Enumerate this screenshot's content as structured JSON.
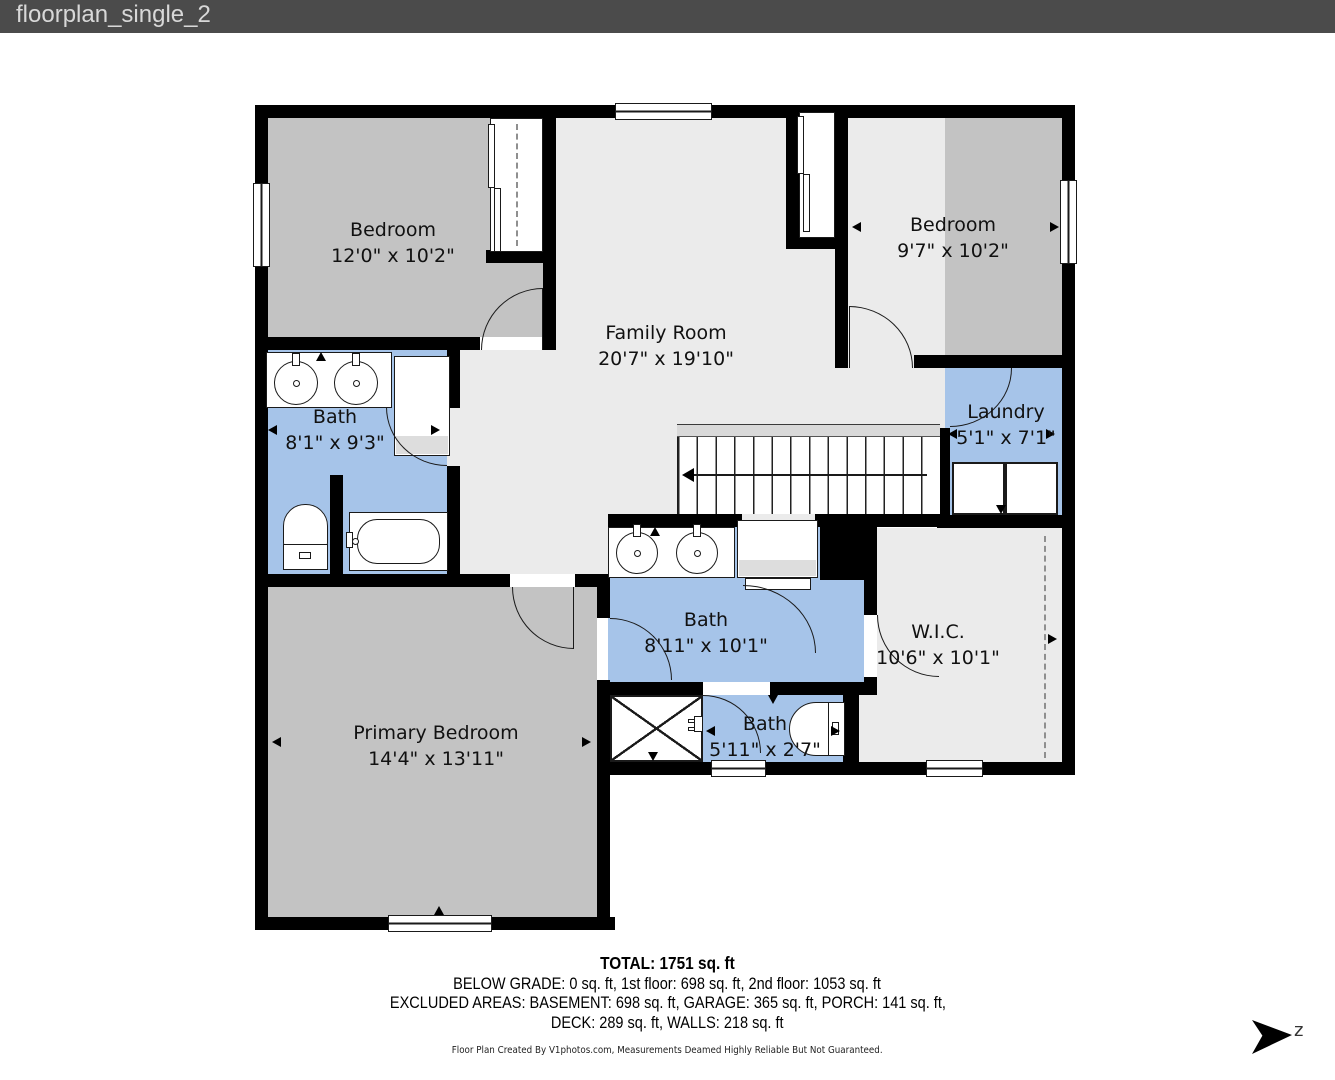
{
  "title_bar": {
    "title": "floorplan_single_2"
  },
  "rooms": [
    {
      "id": "bedroom-left",
      "name": "Bedroom",
      "dims": "12'0\" x 10'2\""
    },
    {
      "id": "family-room",
      "name": "Family Room",
      "dims": "20'7\" x 19'10\""
    },
    {
      "id": "bedroom-right",
      "name": "Bedroom",
      "dims": "9'7\" x 10'2\""
    },
    {
      "id": "bath-left",
      "name": "Bath",
      "dims": "8'1\" x 9'3\""
    },
    {
      "id": "laundry",
      "name": "Laundry",
      "dims": "5'1\" x 7'1\""
    },
    {
      "id": "primary-bedroom",
      "name": "Primary Bedroom",
      "dims": "14'4\" x 13'11\""
    },
    {
      "id": "bath-center",
      "name": "Bath",
      "dims": "8'11\" x 10'1\""
    },
    {
      "id": "wic",
      "name": "W.I.C.",
      "dims": "10'6\" x 10'1\""
    },
    {
      "id": "bath-small",
      "name": "Bath",
      "dims": "5'11\" x 2'7\""
    }
  ],
  "summary": {
    "total": "TOTAL: 1751 sq. ft",
    "line2": "BELOW GRADE: 0 sq. ft, 1st floor: 698 sq. ft, 2nd floor: 1053 sq. ft",
    "line3": "EXCLUDED AREAS: BASEMENT: 698 sq. ft, GARAGE: 365 sq. ft, PORCH: 141 sq. ft,",
    "line4": "DECK: 289 sq. ft, WALLS: 218 sq. ft"
  },
  "disclaimer": "Floor Plan Created By V1photos.com, Measurements Deamed Highly Reliable But Not Guaranteed.",
  "compass": {
    "letter": "z"
  },
  "colors": {
    "titlebar": "#4b4b4b",
    "bedroom_gray": "#c3c3c3",
    "hall_light": "#ebebeb",
    "bath_blue": "#a6c4e9",
    "wall": "#000000"
  }
}
